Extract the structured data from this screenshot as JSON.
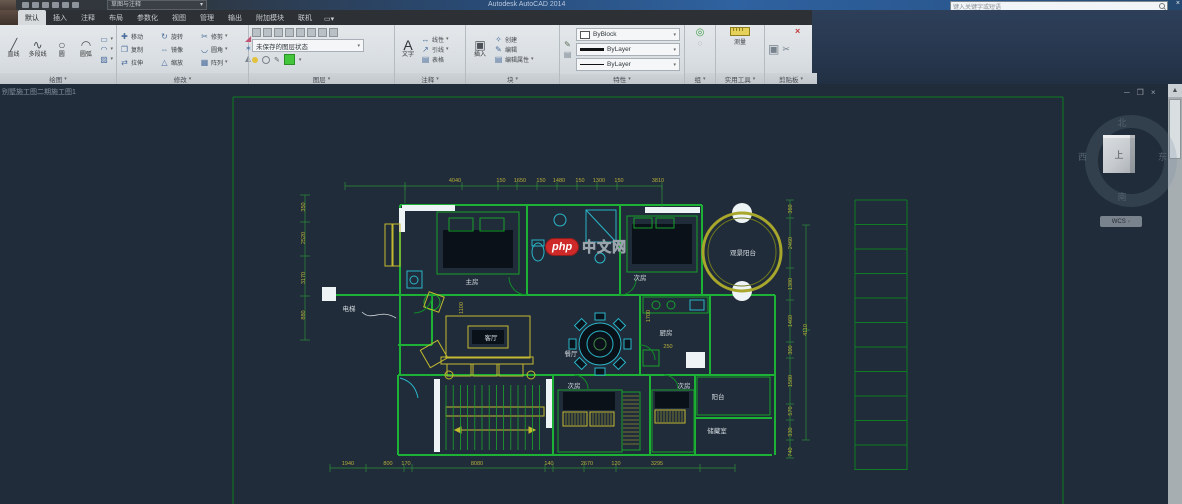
{
  "titlebar": {
    "workspace": "草图与注释",
    "title": "Autodesk AutoCAD 2014",
    "search_placeholder": "键入关键字或短语"
  },
  "icons": {
    "line": "╱",
    "polyline": "∿",
    "circle": "○",
    "arc": "◠",
    "rect_tool": "▭",
    "hatch_tool": "▨",
    "ellipse_tool": "◠",
    "move": "✚",
    "rotate": "↻",
    "trim": "✂",
    "copy": "❐",
    "mirror": "⇔",
    "fillet": "◡",
    "stretch": "⇄",
    "scale": "△",
    "array": "▦",
    "erase": "◢",
    "explode": "✶",
    "fade": "◭",
    "text": "A",
    "dim_linear": "↔",
    "leader": "↗",
    "table": "▤",
    "insert": "▣",
    "create": "✧",
    "edit": "✎",
    "edit_attr": "▤",
    "match_props": "✎",
    "group": "◎",
    "ungroup": "◌",
    "paste": "▣",
    "cut": "✂",
    "close": "×",
    "minimize": "─",
    "restore": "❐",
    "caret": "▾",
    "scroll_up": "▲",
    "panel_toggle": "▭▾"
  },
  "ribbon": {
    "tabs": [
      {
        "label": "默认",
        "active": true
      },
      {
        "label": "插入",
        "active": false
      },
      {
        "label": "注释",
        "active": false
      },
      {
        "label": "布局",
        "active": false
      },
      {
        "label": "参数化",
        "active": false
      },
      {
        "label": "视图",
        "active": false
      },
      {
        "label": "管理",
        "active": false
      },
      {
        "label": "输出",
        "active": false
      },
      {
        "label": "附加模块",
        "active": false
      },
      {
        "label": "联机",
        "active": false
      }
    ],
    "panels": {
      "draw": {
        "label": "绘图",
        "items": [
          "直线",
          "多段线",
          "圆",
          "圆弧"
        ]
      },
      "modify": {
        "label": "修改",
        "items": [
          "移动",
          "旋转",
          "修剪",
          "复制",
          "镜像",
          "圆角",
          "拉伸",
          "缩放",
          "阵列"
        ]
      },
      "layers": {
        "label": "图层",
        "state": "未保存的图层状态"
      },
      "annotation": {
        "label": "注释",
        "items": [
          "文字",
          "线性",
          "引线",
          "表格"
        ]
      },
      "block": {
        "label": "块",
        "items": [
          "插入",
          "创建",
          "编辑",
          "编辑属性"
        ]
      },
      "properties": {
        "label": "特性",
        "rows": [
          "ByBlock",
          "ByLayer",
          "ByLayer"
        ]
      },
      "group": {
        "label": "组"
      },
      "utilities": {
        "label": "实用工具",
        "measure": "测量"
      },
      "clipboard": {
        "label": "剪贴板"
      }
    }
  },
  "canvas": {
    "drawing_tab": "别墅施工图二期施工图1",
    "viewcube": {
      "north": "北",
      "south": "南",
      "west": "西",
      "east": "东",
      "top": "上",
      "wcs": "WCS"
    }
  },
  "floorplan": {
    "watermark": {
      "php": "php",
      "cn": "中文网"
    },
    "rooms": [
      {
        "text": "主房",
        "x": 472,
        "y": 281
      },
      {
        "text": "次房",
        "x": 640,
        "y": 277
      },
      {
        "text": "客厅",
        "x": 491,
        "y": 337
      },
      {
        "text": "餐厅",
        "x": 571,
        "y": 353
      },
      {
        "text": "厨房",
        "x": 666,
        "y": 332
      },
      {
        "text": "观景阳台",
        "x": 743,
        "y": 252
      },
      {
        "text": "电梯",
        "x": 349,
        "y": 308
      },
      {
        "text": "次房",
        "x": 574,
        "y": 385
      },
      {
        "text": "次房",
        "x": 684,
        "y": 385
      },
      {
        "text": "阳台",
        "x": 718,
        "y": 396
      },
      {
        "text": "储藏室",
        "x": 717,
        "y": 430
      }
    ],
    "dims_top": [
      {
        "t": "4040",
        "x": 455,
        "y": 181
      },
      {
        "t": "150",
        "x": 501,
        "y": 181
      },
      {
        "t": "1650",
        "x": 520,
        "y": 181
      },
      {
        "t": "150",
        "x": 541,
        "y": 181
      },
      {
        "t": "1480",
        "x": 559,
        "y": 181
      },
      {
        "t": "150",
        "x": 580,
        "y": 181
      },
      {
        "t": "1300",
        "x": 599,
        "y": 181
      },
      {
        "t": "150",
        "x": 619,
        "y": 181
      },
      {
        "t": "3810",
        "x": 658,
        "y": 181
      }
    ],
    "dims_bottom": [
      {
        "t": "1940",
        "x": 348,
        "y": 464
      },
      {
        "t": "800",
        "x": 388,
        "y": 464
      },
      {
        "t": "170",
        "x": 406,
        "y": 464
      },
      {
        "t": "8080",
        "x": 477,
        "y": 464
      },
      {
        "t": "140",
        "x": 549,
        "y": 464
      },
      {
        "t": "2670",
        "x": 587,
        "y": 464
      },
      {
        "t": "120",
        "x": 616,
        "y": 464
      },
      {
        "t": "3295",
        "x": 657,
        "y": 464
      }
    ],
    "dims_left": [
      {
        "t": "350",
        "x": 304,
        "y": 207
      },
      {
        "t": "2520",
        "x": 304,
        "y": 238
      },
      {
        "t": "3170",
        "x": 304,
        "y": 278
      },
      {
        "t": "880",
        "x": 304,
        "y": 315
      }
    ],
    "dims_right": [
      {
        "t": "360",
        "x": 791,
        "y": 209
      },
      {
        "t": "2460",
        "x": 791,
        "y": 243
      },
      {
        "t": "1380",
        "x": 791,
        "y": 284
      },
      {
        "t": "1460",
        "x": 791,
        "y": 321
      },
      {
        "t": "300",
        "x": 791,
        "y": 350
      },
      {
        "t": "1580",
        "x": 791,
        "y": 381
      },
      {
        "t": "570",
        "x": 791,
        "y": 411
      },
      {
        "t": "330",
        "x": 791,
        "y": 432
      },
      {
        "t": "740",
        "x": 791,
        "y": 452
      }
    ],
    "dims_right_outer": [
      {
        "t": "4110",
        "x": 806,
        "y": 330
      }
    ],
    "dims_inner": [
      {
        "t": "1700",
        "x": 649,
        "y": 316,
        "rot": true
      },
      {
        "t": "1100",
        "x": 462,
        "y": 308,
        "rot": true
      },
      {
        "t": "250",
        "x": 668,
        "y": 347,
        "rot": false
      }
    ]
  }
}
